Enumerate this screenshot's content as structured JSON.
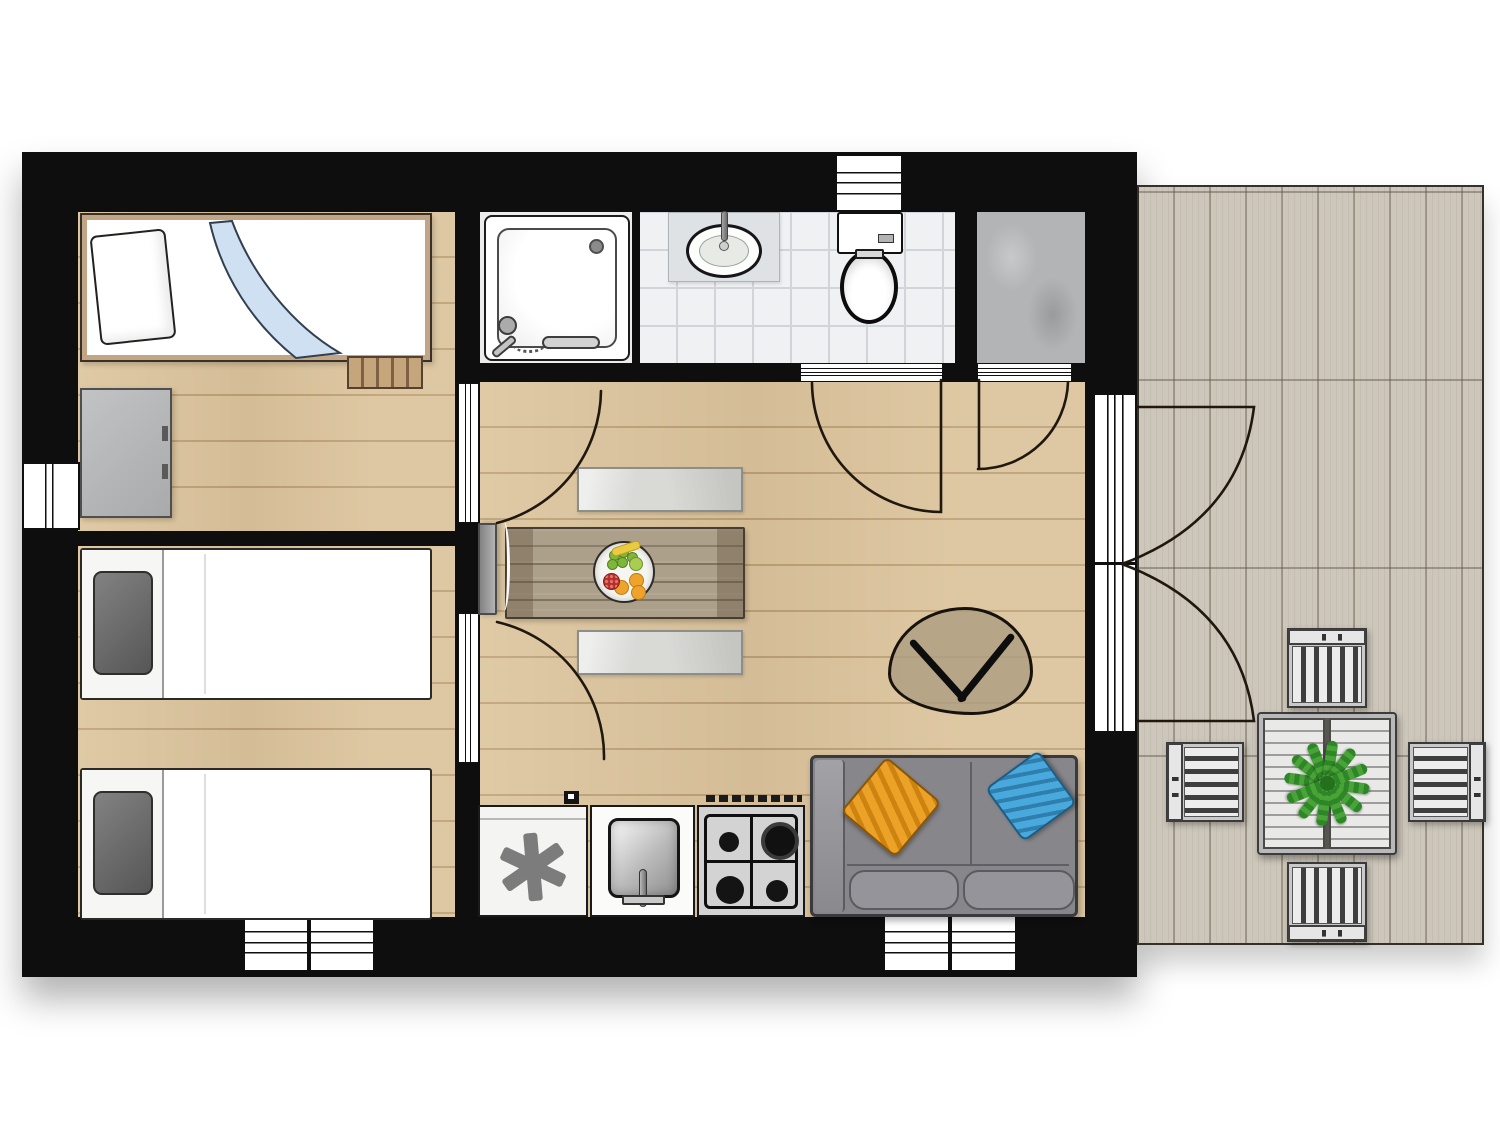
{
  "title": "holiday-home-floor-plan",
  "palette": {
    "wall": "#0e0e0e",
    "wood": "#dcc49c",
    "tile": "#eff1f3",
    "concrete": "#b3b4b6",
    "deck": "#cdc6ba",
    "arc_stroke": "#20170e",
    "accent_pillow_orange": "#eca227",
    "accent_pillow_blue": "#49a8dc",
    "plant_green": "#3a9330"
  },
  "plan": {
    "size": {
      "w": 1500,
      "h": 1125
    },
    "shadows": [
      {
        "name": "house-shadow",
        "kind": "house",
        "x": 22,
        "y": 152,
        "w": 1115,
        "h": 825
      },
      {
        "name": "deck-shadow",
        "kind": "deck",
        "x": 1137,
        "y": 185,
        "w": 347,
        "h": 760
      }
    ],
    "deck": {
      "name": "deck-terrace",
      "x": 1137,
      "y": 185,
      "w": 347,
      "h": 760
    },
    "floors": [
      {
        "name": "bedroom-1-floor",
        "type": "wood",
        "x": 78,
        "y": 212,
        "w": 379,
        "h": 319
      },
      {
        "name": "bedroom-2-floor",
        "type": "wood",
        "x": 78,
        "y": 546,
        "w": 379,
        "h": 371
      },
      {
        "name": "living-kitchen-floor",
        "type": "wood",
        "x": 480,
        "y": 382,
        "w": 605,
        "h": 535
      },
      {
        "name": "shower-floor",
        "type": "plain",
        "x": 480,
        "y": 212,
        "w": 156,
        "h": 151
      },
      {
        "name": "bathroom-floor",
        "type": "tile",
        "x": 640,
        "y": 212,
        "w": 315,
        "h": 151
      },
      {
        "name": "storage-floor",
        "type": "concrete",
        "x": 977,
        "y": 212,
        "w": 108,
        "h": 151
      }
    ],
    "walls": [
      {
        "name": "wall-top",
        "x": 22,
        "y": 152,
        "w": 1115,
        "h": 60
      },
      {
        "name": "wall-bottom",
        "x": 22,
        "y": 917,
        "w": 1115,
        "h": 60
      },
      {
        "name": "wall-left",
        "x": 22,
        "y": 212,
        "w": 56,
        "h": 705
      },
      {
        "name": "wall-right",
        "x": 1085,
        "y": 212,
        "w": 52,
        "h": 705
      },
      {
        "name": "wall-partition-main",
        "x": 455,
        "y": 212,
        "w": 25,
        "h": 705
      },
      {
        "name": "wall-bedroom-divider",
        "x": 78,
        "y": 531,
        "w": 379,
        "h": 15
      },
      {
        "name": "wall-bathroom-south",
        "x": 455,
        "y": 363,
        "w": 630,
        "h": 19
      },
      {
        "name": "wall-shower-bath",
        "x": 632,
        "y": 212,
        "w": 8,
        "h": 151
      },
      {
        "name": "wall-bath-storage",
        "x": 955,
        "y": 212,
        "w": 22,
        "h": 170
      }
    ],
    "windows": [
      {
        "name": "window-bedroom2-west",
        "dir": "v",
        "x": 22,
        "y": 462,
        "w": 58,
        "h": 68
      },
      {
        "name": "window-toilet-north",
        "dir": "h",
        "x": 835,
        "y": 154,
        "w": 68,
        "h": 58
      },
      {
        "name": "window-bedroom2-south",
        "dir": "h",
        "split": true,
        "x": 243,
        "y": 913,
        "w": 132,
        "h": 59
      },
      {
        "name": "window-living-south",
        "dir": "h",
        "split": true,
        "x": 883,
        "y": 913,
        "w": 134,
        "h": 59
      },
      {
        "name": "french-door-east",
        "dir": "french",
        "x": 1093,
        "y": 393,
        "w": 44,
        "h": 340
      }
    ],
    "door_leaves": [
      {
        "name": "bedroom1-door-leaf",
        "dir": "v",
        "x": 458,
        "y": 383,
        "w": 21,
        "h": 140
      },
      {
        "name": "bedroom2-door-leaf",
        "dir": "v",
        "x": 458,
        "y": 613,
        "w": 21,
        "h": 150
      },
      {
        "name": "bathroom-door-sill",
        "dir": "h",
        "x": 800,
        "y": 363,
        "w": 143,
        "h": 19
      },
      {
        "name": "storage-door-sill",
        "dir": "h",
        "x": 977,
        "y": 363,
        "w": 95,
        "h": 19
      }
    ],
    "door_arcs": [
      {
        "name": "bedroom1-door-swing",
        "d": "M 601 391 A 138 138 0 0 1 497 523"
      },
      {
        "name": "bedroom2-door-swing",
        "d": "M 497 622 A 138 138 0 0 1 604 759"
      },
      {
        "name": "bathroom-door-swing",
        "d": "M 812 383 A 130 130 0 0 0 941 512 L 941 380"
      },
      {
        "name": "storage-door-swing",
        "d": "M 978 469 A 90 90 0 0 0 1068 382 M 979 380 L 979 469"
      },
      {
        "name": "entry-door-swing-upper",
        "d": "M 1137 407 L 1254 407 Q 1240 520 1122 564"
      },
      {
        "name": "entry-door-swing-lower",
        "d": "M 1137 721 L 1254 721 Q 1240 608 1122 564"
      }
    ],
    "furniture": [
      {
        "type": "bed-blue",
        "name": "bed-single-1",
        "x": 80,
        "y": 213,
        "w": 352,
        "h": 149
      },
      {
        "type": "rack",
        "name": "luggage-rack",
        "x": 347,
        "y": 356,
        "w": 76,
        "h": 33
      },
      {
        "type": "dresser",
        "name": "dresser",
        "x": 80,
        "y": 388,
        "w": 92,
        "h": 130
      },
      {
        "type": "bed-gray",
        "name": "bed-single-2",
        "x": 80,
        "y": 548,
        "w": 352,
        "h": 152
      },
      {
        "type": "bed-gray",
        "name": "bed-single-3",
        "x": 80,
        "y": 768,
        "w": 352,
        "h": 152
      },
      {
        "type": "shower",
        "name": "shower",
        "x": 484,
        "y": 215,
        "w": 146,
        "h": 146
      },
      {
        "type": "bathsink",
        "name": "bathroom-sink",
        "x": 668,
        "y": 212,
        "w": 112,
        "h": 70
      },
      {
        "type": "toilet",
        "name": "toilet",
        "x": 837,
        "y": 212,
        "w": 66,
        "h": 112
      },
      {
        "type": "table",
        "name": "dining-table",
        "x": 505,
        "y": 527,
        "w": 240,
        "h": 92
      },
      {
        "type": "bench",
        "name": "bench-north",
        "x": 577,
        "y": 467,
        "w": 166,
        "h": 45
      },
      {
        "type": "bench",
        "name": "bench-south",
        "x": 577,
        "y": 630,
        "w": 166,
        "h": 45
      },
      {
        "type": "fruit",
        "name": "fruit-bowl",
        "x": 593,
        "y": 541,
        "w": 62,
        "h": 62
      },
      {
        "type": "tv",
        "name": "tv-panel",
        "x": 478,
        "y": 523,
        "w": 19,
        "h": 92
      },
      {
        "type": "ctable",
        "name": "coffee-table",
        "x": 888,
        "y": 607,
        "w": 145,
        "h": 108
      },
      {
        "type": "sofa",
        "name": "sofa",
        "x": 810,
        "y": 755,
        "w": 268,
        "h": 162
      },
      {
        "type": "fridge",
        "name": "fridge-freezer",
        "x": 478,
        "y": 805,
        "w": 110,
        "h": 112
      },
      {
        "type": "ksink",
        "name": "kitchen-sink",
        "x": 590,
        "y": 805,
        "w": 105,
        "h": 112
      },
      {
        "type": "stove",
        "name": "gas-stove",
        "x": 697,
        "y": 805,
        "w": 108,
        "h": 112
      },
      {
        "type": "socket",
        "name": "wall-switch",
        "x": 564,
        "y": 791,
        "w": 15,
        "h": 13
      },
      {
        "type": "otable",
        "name": "patio-table",
        "x": 1257,
        "y": 712,
        "w": 140,
        "h": 143
      },
      {
        "type": "plant",
        "name": "potted-plant",
        "x": 1283,
        "y": 739,
        "w": 88,
        "h": 88
      },
      {
        "type": "chair",
        "dir": "top",
        "name": "patio-chair-north",
        "x": 1287,
        "y": 628,
        "w": 80,
        "h": 80
      },
      {
        "type": "chair",
        "dir": "bottom",
        "name": "patio-chair-south",
        "x": 1287,
        "y": 862,
        "w": 80,
        "h": 80
      },
      {
        "type": "chair",
        "dir": "left",
        "name": "patio-chair-west",
        "x": 1166,
        "y": 742,
        "w": 78,
        "h": 80
      },
      {
        "type": "chair",
        "dir": "right",
        "name": "patio-chair-east",
        "x": 1408,
        "y": 742,
        "w": 78,
        "h": 80
      }
    ],
    "fruit_items": [
      {
        "cls": "fr-grape",
        "x": 14,
        "y": 7
      },
      {
        "cls": "fr-grape",
        "x": 23,
        "y": 4
      },
      {
        "cls": "fr-grape",
        "x": 32,
        "y": 9
      },
      {
        "cls": "fr-grape",
        "x": 12,
        "y": 16
      },
      {
        "cls": "fr-grape",
        "x": 22,
        "y": 14
      },
      {
        "cls": "fr-lime",
        "x": 34,
        "y": 14
      },
      {
        "cls": "fr-banana",
        "x": 16,
        "y": 1
      },
      {
        "cls": "fr-orange",
        "x": 34,
        "y": 30
      },
      {
        "cls": "fr-orange",
        "x": 19,
        "y": 37
      },
      {
        "cls": "fr-orange",
        "x": 36,
        "y": 42
      },
      {
        "cls": "fr-red",
        "x": 8,
        "y": 30
      }
    ],
    "blanket_path": "M 150 6 C 170 60 210 110 258 138 L 214 143 C 170 108 140 60 128 8 Z",
    "star_angles": [
      25,
      85,
      145
    ],
    "frond_angles": [
      8,
      38,
      68,
      98,
      128,
      158
    ]
  }
}
